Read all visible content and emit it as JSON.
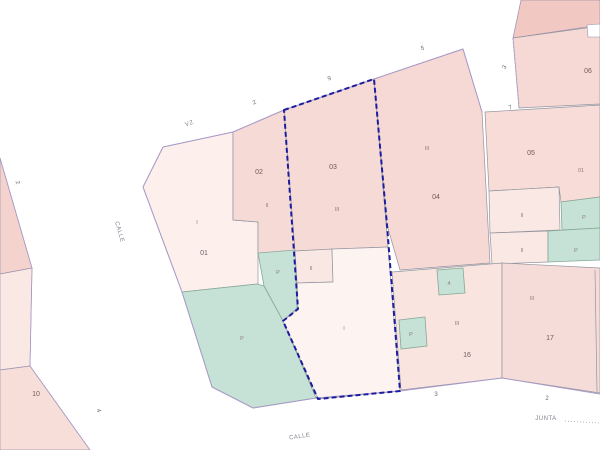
{
  "map": {
    "type": "cadastral-parcel-map",
    "selection_color": "#1c1c9e",
    "parcel_fill": "#f6d9d5",
    "green_fill": "#c6e2d6",
    "parcel_labels": {
      "p01": "01",
      "p01_sub": "I",
      "p02": "02",
      "p02_sub": "II",
      "p03": "03",
      "p03_sub": "III",
      "p04": "04",
      "p04_sub": "III",
      "p05": "05",
      "p05_sub": "01",
      "p06": "06",
      "p10": "10",
      "p16": "16",
      "p16_sub": "III",
      "p17": "17",
      "p17_sub": "III",
      "selected": "I",
      "inner_box": "II",
      "row1_light": "II",
      "row2_light": "II"
    },
    "green_labels": {
      "big": "P",
      "small": "P",
      "row1": "P",
      "row2": "P",
      "sq1": "4",
      "sq2": "P"
    },
    "street_names": {
      "top": "VZ",
      "left": "CALLE",
      "bottom": "CALLE",
      "junta": "JUNTA"
    },
    "house_numbers": {
      "top_2": "2",
      "top_9": "9",
      "top_5": "5",
      "top_3": "3",
      "top_7": "7",
      "bottom_3": "3",
      "bottom_2": "2",
      "left_2": "2",
      "left_4": "4"
    }
  }
}
